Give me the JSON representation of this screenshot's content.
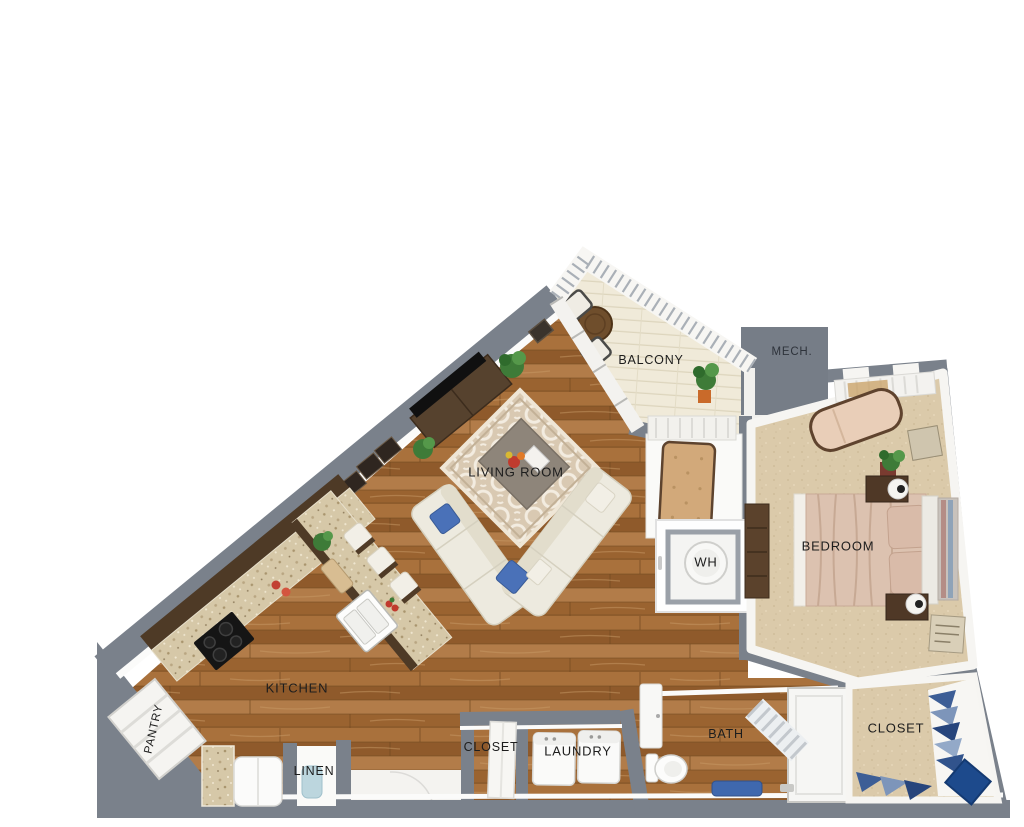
{
  "floorplan": {
    "rooms": {
      "living_room": {
        "label": "LIVING ROOM"
      },
      "kitchen": {
        "label": "KITCHEN"
      },
      "bedroom": {
        "label": "BEDROOM"
      },
      "balcony": {
        "label": "BALCONY"
      },
      "mech": {
        "label": "MECH."
      },
      "water_heater": {
        "label": "WH"
      },
      "pantry": {
        "label": "PANTRY"
      },
      "linen": {
        "label": "LINEN"
      },
      "closet_hall": {
        "label": "CLOSET"
      },
      "laundry": {
        "label": "LAUNDRY"
      },
      "bath": {
        "label": "BATH"
      },
      "closet_bedroom": {
        "label": "CLOSET"
      }
    },
    "colors": {
      "wall_gray": "#7a818b",
      "wood_floor": "#a06b38",
      "carpet_beige": "#dbcaaa",
      "balcony_floor": "#f0ead9",
      "granite_counter": "#d6c8a8",
      "cabinet_brown": "#4e3a26",
      "sofa_cream": "#edeadf",
      "pillow_blue": "#4a71b8",
      "bed_blush": "#dcc2b0",
      "closet_navy": "#1d4a8c"
    }
  }
}
